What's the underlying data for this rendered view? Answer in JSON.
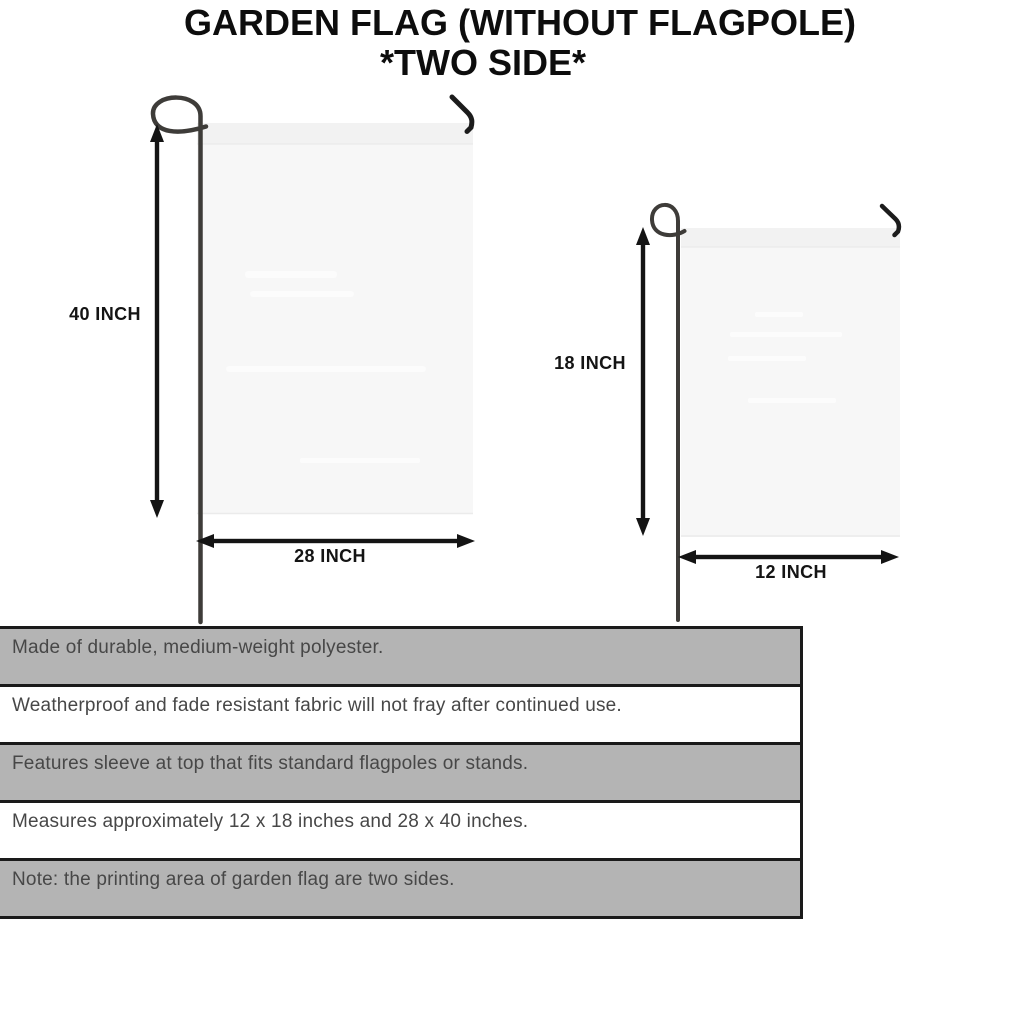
{
  "title": {
    "line1": "GARDEN FLAG (WITHOUT FLAGPOLE)",
    "line2": "*TWO SIDE*"
  },
  "diagram": {
    "large_flag": {
      "height_label": "40 INCH",
      "width_label": "28 INCH"
    },
    "small_flag": {
      "height_label": "18 INCH",
      "width_label": "12 INCH"
    }
  },
  "features": {
    "rows": [
      "Made of durable, medium-weight polyester.",
      "Weatherproof and fade resistant fabric will not fray after continued use.",
      "Features sleeve at top that fits standard flagpoles or stands.",
      "Measures approximately 12 x 18 inches and 28 x 40 inches.",
      "Note: the printing area of garden flag are two sides."
    ]
  },
  "colors": {
    "background": "#ffffff",
    "ink": "#0d0d0d",
    "row_gray": "#b4b4b4",
    "row_border": "#1a1a1a",
    "row_text": "#474747",
    "flag_fill": "#f7f7f7",
    "flag_sleeve": "#f2f2f2",
    "pole": "#3e3c39",
    "arrow": "#141414"
  }
}
